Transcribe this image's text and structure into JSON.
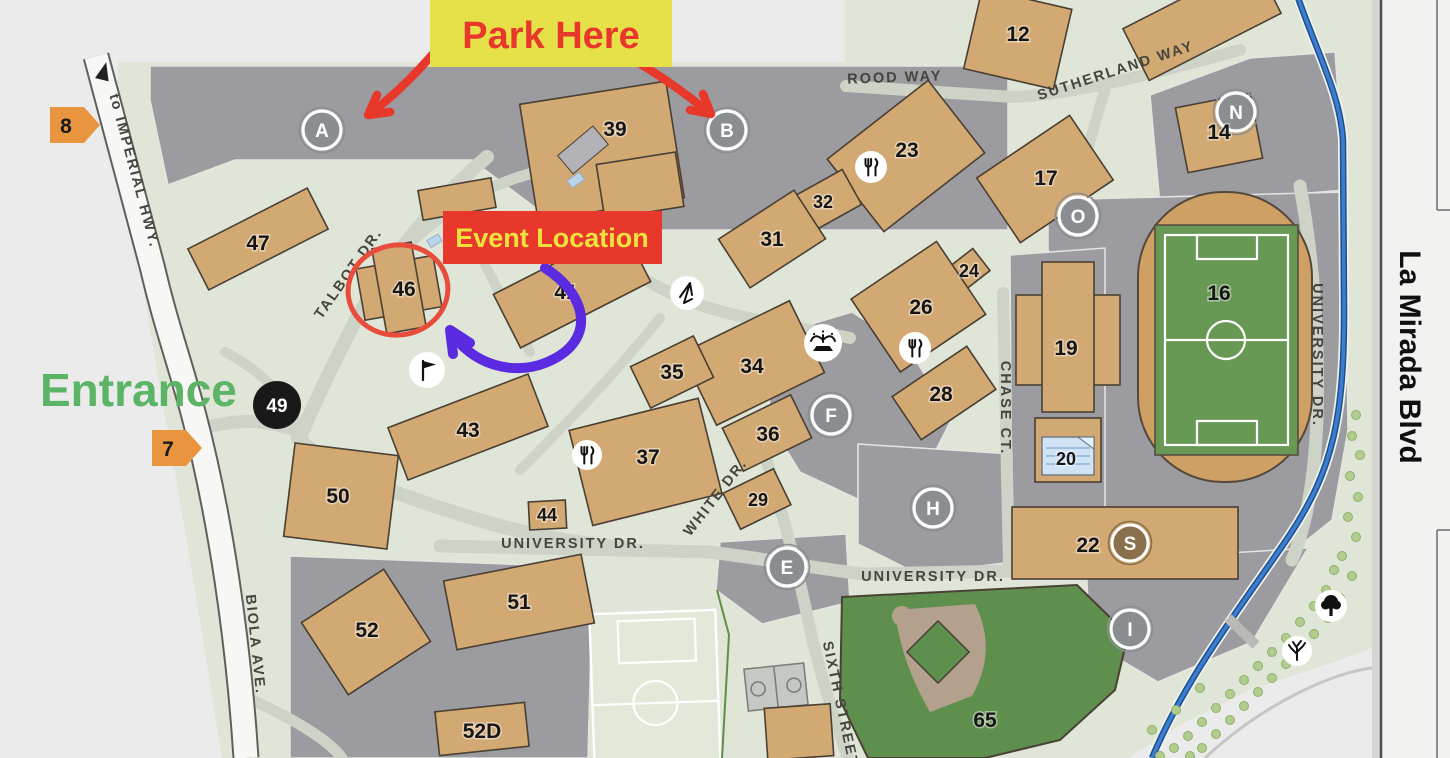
{
  "annotations": {
    "park_here": "Park Here",
    "event_location": "Event Location",
    "entrance": "Entrance"
  },
  "gates": {
    "g8": "8",
    "g7": "7"
  },
  "roads": {
    "imperial": "to IMPERIAL HWY.",
    "biola": "BIOLA AVE.",
    "la_mirada": "La Mirada Blvd",
    "rood": "ROOD WAY",
    "sutherland": "SUTHERLAND WAY",
    "university_west": "UNIVERSITY DR.",
    "university_east": "UNIVERSITY DR.",
    "university_vertical": "UNIVERSITY DR.",
    "talbot": "TALBOT DR.",
    "white": "WHITE DR.",
    "chase": "CHASE CT.",
    "sixth": "SIXTH STREET"
  },
  "parking_markers": {
    "A": "A",
    "B": "B",
    "N": "N",
    "O": "O",
    "F": "F",
    "H": "H",
    "E": "E",
    "I": "I",
    "S": "S"
  },
  "spot49": "49",
  "buildings": {
    "b12": "12",
    "b14": "14",
    "b16": "16",
    "b17": "17",
    "b19": "19",
    "b20": "20",
    "b22": "22",
    "b23": "23",
    "b24": "24",
    "b26": "26",
    "b28": "28",
    "b29": "29",
    "b31": "31",
    "b32": "32",
    "b34": "34",
    "b35": "35",
    "b36": "36",
    "b37": "37",
    "b39": "39",
    "b41": "41",
    "b43": "43",
    "b44": "44",
    "b46": "46",
    "b47": "47",
    "b50": "50",
    "b51": "51",
    "b52": "52",
    "b52d": "52D",
    "b65": "65"
  },
  "icons": [
    "dining-icon",
    "flag-icon",
    "fountain-icon",
    "landmark-icon",
    "tree-icon",
    "shrub-icon",
    "up-arrow-icon"
  ],
  "colors": {
    "banner_yellow": "#e6e049",
    "banner_red": "#e8382b",
    "entrance_green": "#5cb466",
    "arrow_red": "#e8382b",
    "arrow_purple": "#5a2be0",
    "highlight_circle": "#e84c3d",
    "building_tan": "#d2a972",
    "parking_gray": "#9b9ba0",
    "campus_green": "#e0e6d7",
    "field_green": "#679954",
    "baseball_green": "#5f8f4d",
    "track_tan": "#cfa064",
    "creek_blue": "#3b7ed0",
    "gate_orange": "#e9953f",
    "marker_gray": "#8a8e91",
    "marker_s_brown": "#8a6f4d"
  }
}
